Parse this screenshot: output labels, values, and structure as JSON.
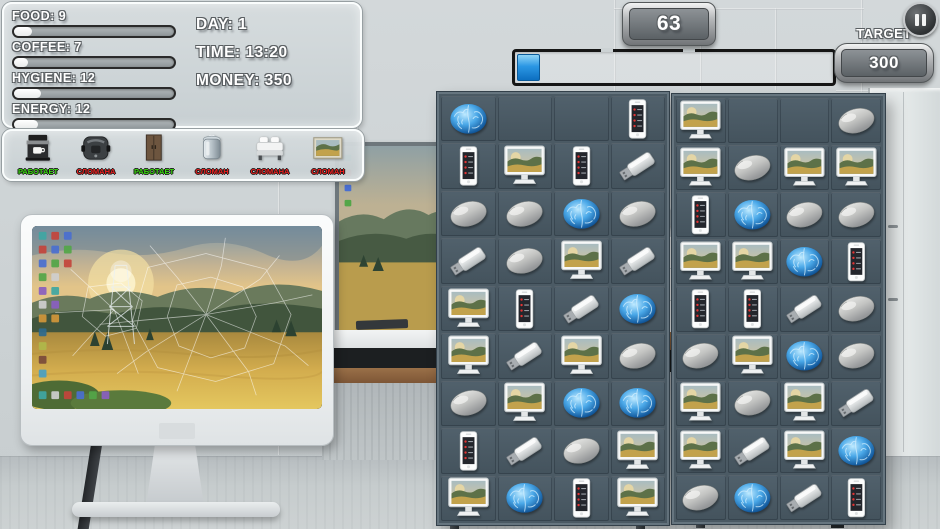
{
  "hud": {
    "stats": [
      {
        "id": "food",
        "label": "FOOD: 9",
        "pct": 11
      },
      {
        "id": "coffee",
        "label": "COFFEE: 7",
        "pct": 9
      },
      {
        "id": "hygiene",
        "label": "HYGIENE: 12",
        "pct": 17
      },
      {
        "id": "energy",
        "label": "ENERGY: 12",
        "pct": 15
      }
    ],
    "info": {
      "day": "DAY: 1",
      "time": "TIME: 13:20",
      "money": "MONEY: 350"
    },
    "score": "63",
    "target_label": "TARGET",
    "target_value": "300",
    "progress_pct": 6.5
  },
  "status_colors": {
    "working": "#38d60e",
    "broken": "#ef1f1f"
  },
  "appliances": [
    {
      "icon": "coffee-machine",
      "status": "РАБОТАЕТ",
      "state": "working"
    },
    {
      "icon": "multicooker",
      "status": "СЛОМАНА",
      "state": "broken"
    },
    {
      "icon": "wardrobe",
      "status": "РАБОТАЕТ",
      "state": "working"
    },
    {
      "icon": "boiler",
      "status": "СЛОМАН",
      "state": "broken"
    },
    {
      "icon": "bed",
      "status": "СЛОМАНА",
      "state": "broken"
    },
    {
      "icon": "picture",
      "status": "СЛОМАН",
      "state": "broken"
    }
  ],
  "boards": [
    {
      "name": "left",
      "cells": [
        [
          "brain",
          "",
          "",
          "phone"
        ],
        [
          "phone",
          "monitor",
          "phone",
          "usb"
        ],
        [
          "mouse",
          "mouse",
          "brain",
          "mouse"
        ],
        [
          "usb",
          "mouse",
          "monitor",
          "usb"
        ],
        [
          "monitor",
          "phone",
          "usb",
          "brain"
        ],
        [
          "monitor",
          "usb",
          "monitor",
          "mouse"
        ],
        [
          "mouse",
          "monitor",
          "brain",
          "brain"
        ],
        [
          "phone",
          "usb",
          "mouse",
          "monitor"
        ],
        [
          "monitor",
          "brain",
          "phone",
          "monitor"
        ]
      ]
    },
    {
      "name": "right",
      "cells": [
        [
          "monitor",
          "",
          "",
          "mouse"
        ],
        [
          "monitor",
          "mouse",
          "monitor",
          "monitor"
        ],
        [
          "phone",
          "brain",
          "mouse",
          "mouse"
        ],
        [
          "monitor",
          "monitor",
          "brain",
          "phone"
        ],
        [
          "phone",
          "phone",
          "usb",
          "mouse"
        ],
        [
          "mouse",
          "monitor",
          "brain",
          "mouse"
        ],
        [
          "monitor",
          "mouse",
          "monitor",
          "usb"
        ],
        [
          "monitor",
          "usb",
          "monitor",
          "brain"
        ],
        [
          "mouse",
          "brain",
          "usb",
          "phone"
        ]
      ]
    }
  ]
}
